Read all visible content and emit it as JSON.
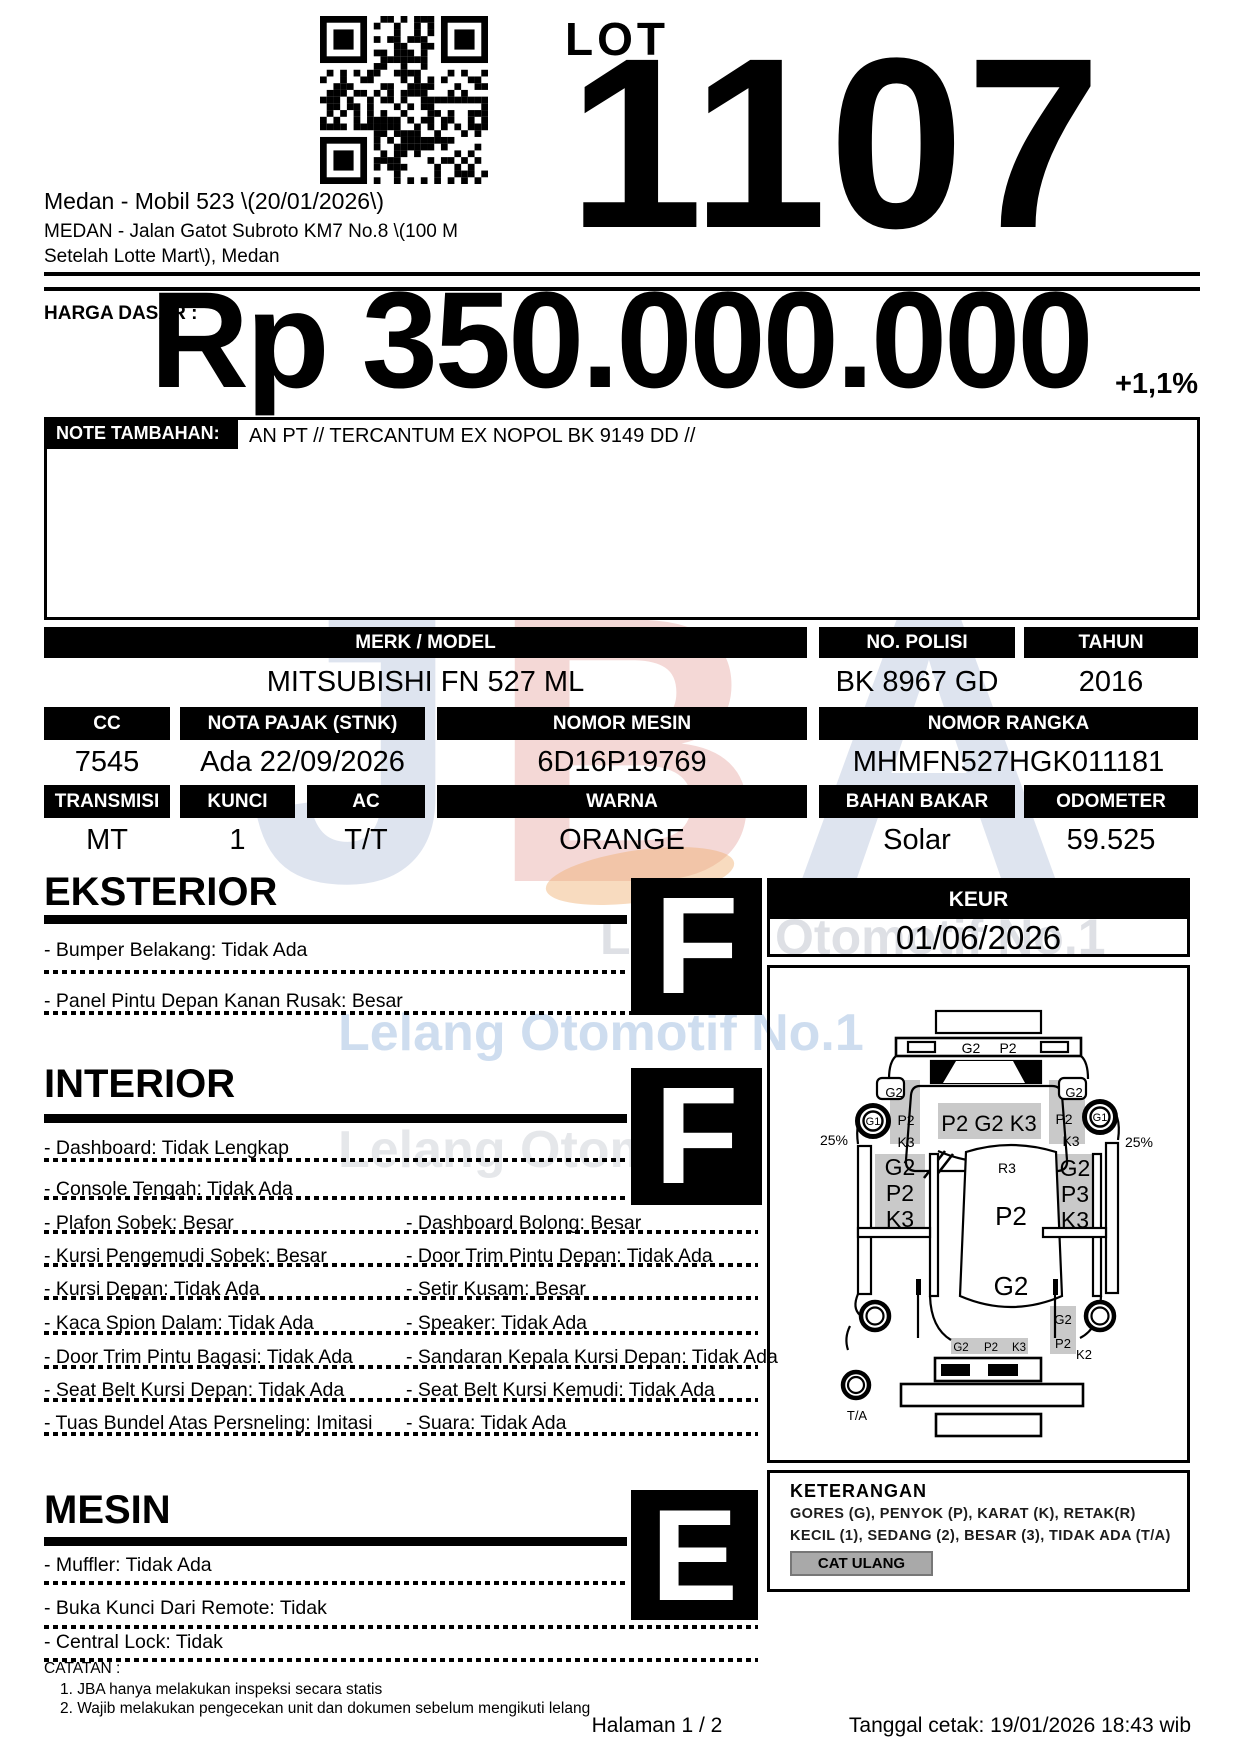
{
  "header": {
    "lot_label": "LOT",
    "lot_number": "1107",
    "title": "Medan - Mobil 523 \\(20/01/2026\\)",
    "address_line1": "MEDAN - Jalan Gatot Subroto KM7 No.8 \\(100 M",
    "address_line2": "Setelah Lotte Mart\\), Medan"
  },
  "price": {
    "label": "HARGA DASAR :",
    "value": "Rp 350.000.000",
    "change": "+1,1%"
  },
  "note": {
    "label": "NOTE TAMBAHAN:",
    "text": "AN PT // TERCANTUM EX NOPOL BK 9149 DD //"
  },
  "vehicle": {
    "row1": {
      "headers": [
        "MERK / MODEL",
        "NO. POLISI",
        "TAHUN"
      ],
      "values": [
        "MITSUBISHI FN 527 ML",
        "BK 8967 GD",
        "2016"
      ]
    },
    "row2": {
      "headers": [
        "CC",
        "NOTA PAJAK (STNK)",
        "NOMOR MESIN",
        "NOMOR RANGKA"
      ],
      "values": [
        "7545",
        "Ada 22/09/2026",
        "6D16P19769",
        "MHMFN527HGK011181"
      ]
    },
    "row3": {
      "headers": [
        "TRANSMISI",
        "KUNCI",
        "AC",
        "WARNA",
        "BAHAN BAKAR",
        "ODOMETER"
      ],
      "values": [
        "MT",
        "1",
        "T/T",
        "ORANGE",
        "Solar",
        "59.525"
      ]
    }
  },
  "sections": {
    "eksterior": {
      "title": "EKSTERIOR",
      "grade": "F",
      "items": [
        "- Bumper Belakang: Tidak Ada",
        "- Panel Pintu Depan Kanan Rusak: Besar"
      ]
    },
    "interior": {
      "title": "INTERIOR",
      "grade": "F",
      "rows": [
        {
          "l": "- Dashboard: Tidak Lengkap",
          "r": ""
        },
        {
          "l": "- Console Tengah: Tidak Ada",
          "r": ""
        },
        {
          "l": "- Plafon Sobek: Besar",
          "r": "- Dashboard Bolong: Besar"
        },
        {
          "l": "- Kursi Pengemudi Sobek: Besar",
          "r": "- Door Trim Pintu Depan: Tidak Ada"
        },
        {
          "l": "- Kursi Depan: Tidak Ada",
          "r": "- Setir Kusam: Besar"
        },
        {
          "l": "- Kaca Spion Dalam: Tidak Ada",
          "r": "- Speaker: Tidak Ada"
        },
        {
          "l": "- Door Trim Pintu Bagasi: Tidak Ada",
          "r": "- Sandaran Kepala Kursi Depan: Tidak Ada"
        },
        {
          "l": "- Seat Belt Kursi Depan: Tidak Ada",
          "r": "- Seat Belt Kursi Kemudi: Tidak Ada"
        },
        {
          "l": "- Tuas Bundel Atas Persneling: Imitasi",
          "r": "- Suara: Tidak Ada"
        }
      ]
    },
    "mesin": {
      "title": "MESIN",
      "grade": "E",
      "items": [
        "- Muffler: Tidak Ada",
        "- Buka Kunci Dari Remote: Tidak",
        "- Central Lock: Tidak"
      ]
    }
  },
  "keur": {
    "label": "KEUR",
    "value": "01/06/2026"
  },
  "diagram": {
    "front": [
      "G2",
      "P2"
    ],
    "mirror_left": "G2",
    "mirror_right": "G2",
    "fender_left": [
      "P2",
      "K3"
    ],
    "fender_right": [
      "P2",
      "K3"
    ],
    "wheel_front_left": "G1",
    "wheel_front_right": "G1",
    "pct_left": "25%",
    "pct_right": "25%",
    "roof": "P2 G2 K3",
    "rear_window": "R3",
    "door_left": [
      "G2",
      "P2",
      "K3"
    ],
    "door_right": [
      "G2",
      "P3",
      "K3"
    ],
    "cargo": [
      "P2",
      "G2"
    ],
    "rear_center": [
      "G2",
      "P2",
      "K3"
    ],
    "rear_right": [
      "G2",
      "P2",
      "K2"
    ],
    "spare": "T/A"
  },
  "keterangan": {
    "title": "KETERANGAN",
    "line1": "GORES (G), PENYOK (P), KARAT (K), RETAK(R)",
    "line2": "KECIL (1), SEDANG (2), BESAR (3), TIDAK ADA (T/A)",
    "button": "CAT ULANG"
  },
  "catatan": {
    "title": "CATATAN :",
    "items": [
      "1. JBA hanya melakukan inspeksi secara statis",
      "2. Wajib melakukan pengecekan unit dan dokumen sebelum mengikuti lelang"
    ]
  },
  "footer": {
    "page": "Halaman 1 / 2",
    "printed": "Tanggal cetak: 19/01/2026 18:43 wib"
  },
  "watermark": {
    "logo": "JBA",
    "text_top": "Lelang Otomotif No.1",
    "text_mid": "Lelang Otomotif No.1",
    "text_bottom": "Lelang Otomotif"
  },
  "colors": {
    "wm_blue": "#b5cbe7",
    "wm_gray": "#d8dbe0",
    "logo_blue": "#b3bfda",
    "logo_red": "#e6a39e",
    "logo_orange": "#f0b070",
    "diagram_gray": "#c9c9c9",
    "button_gray": "#a9a9a9"
  }
}
